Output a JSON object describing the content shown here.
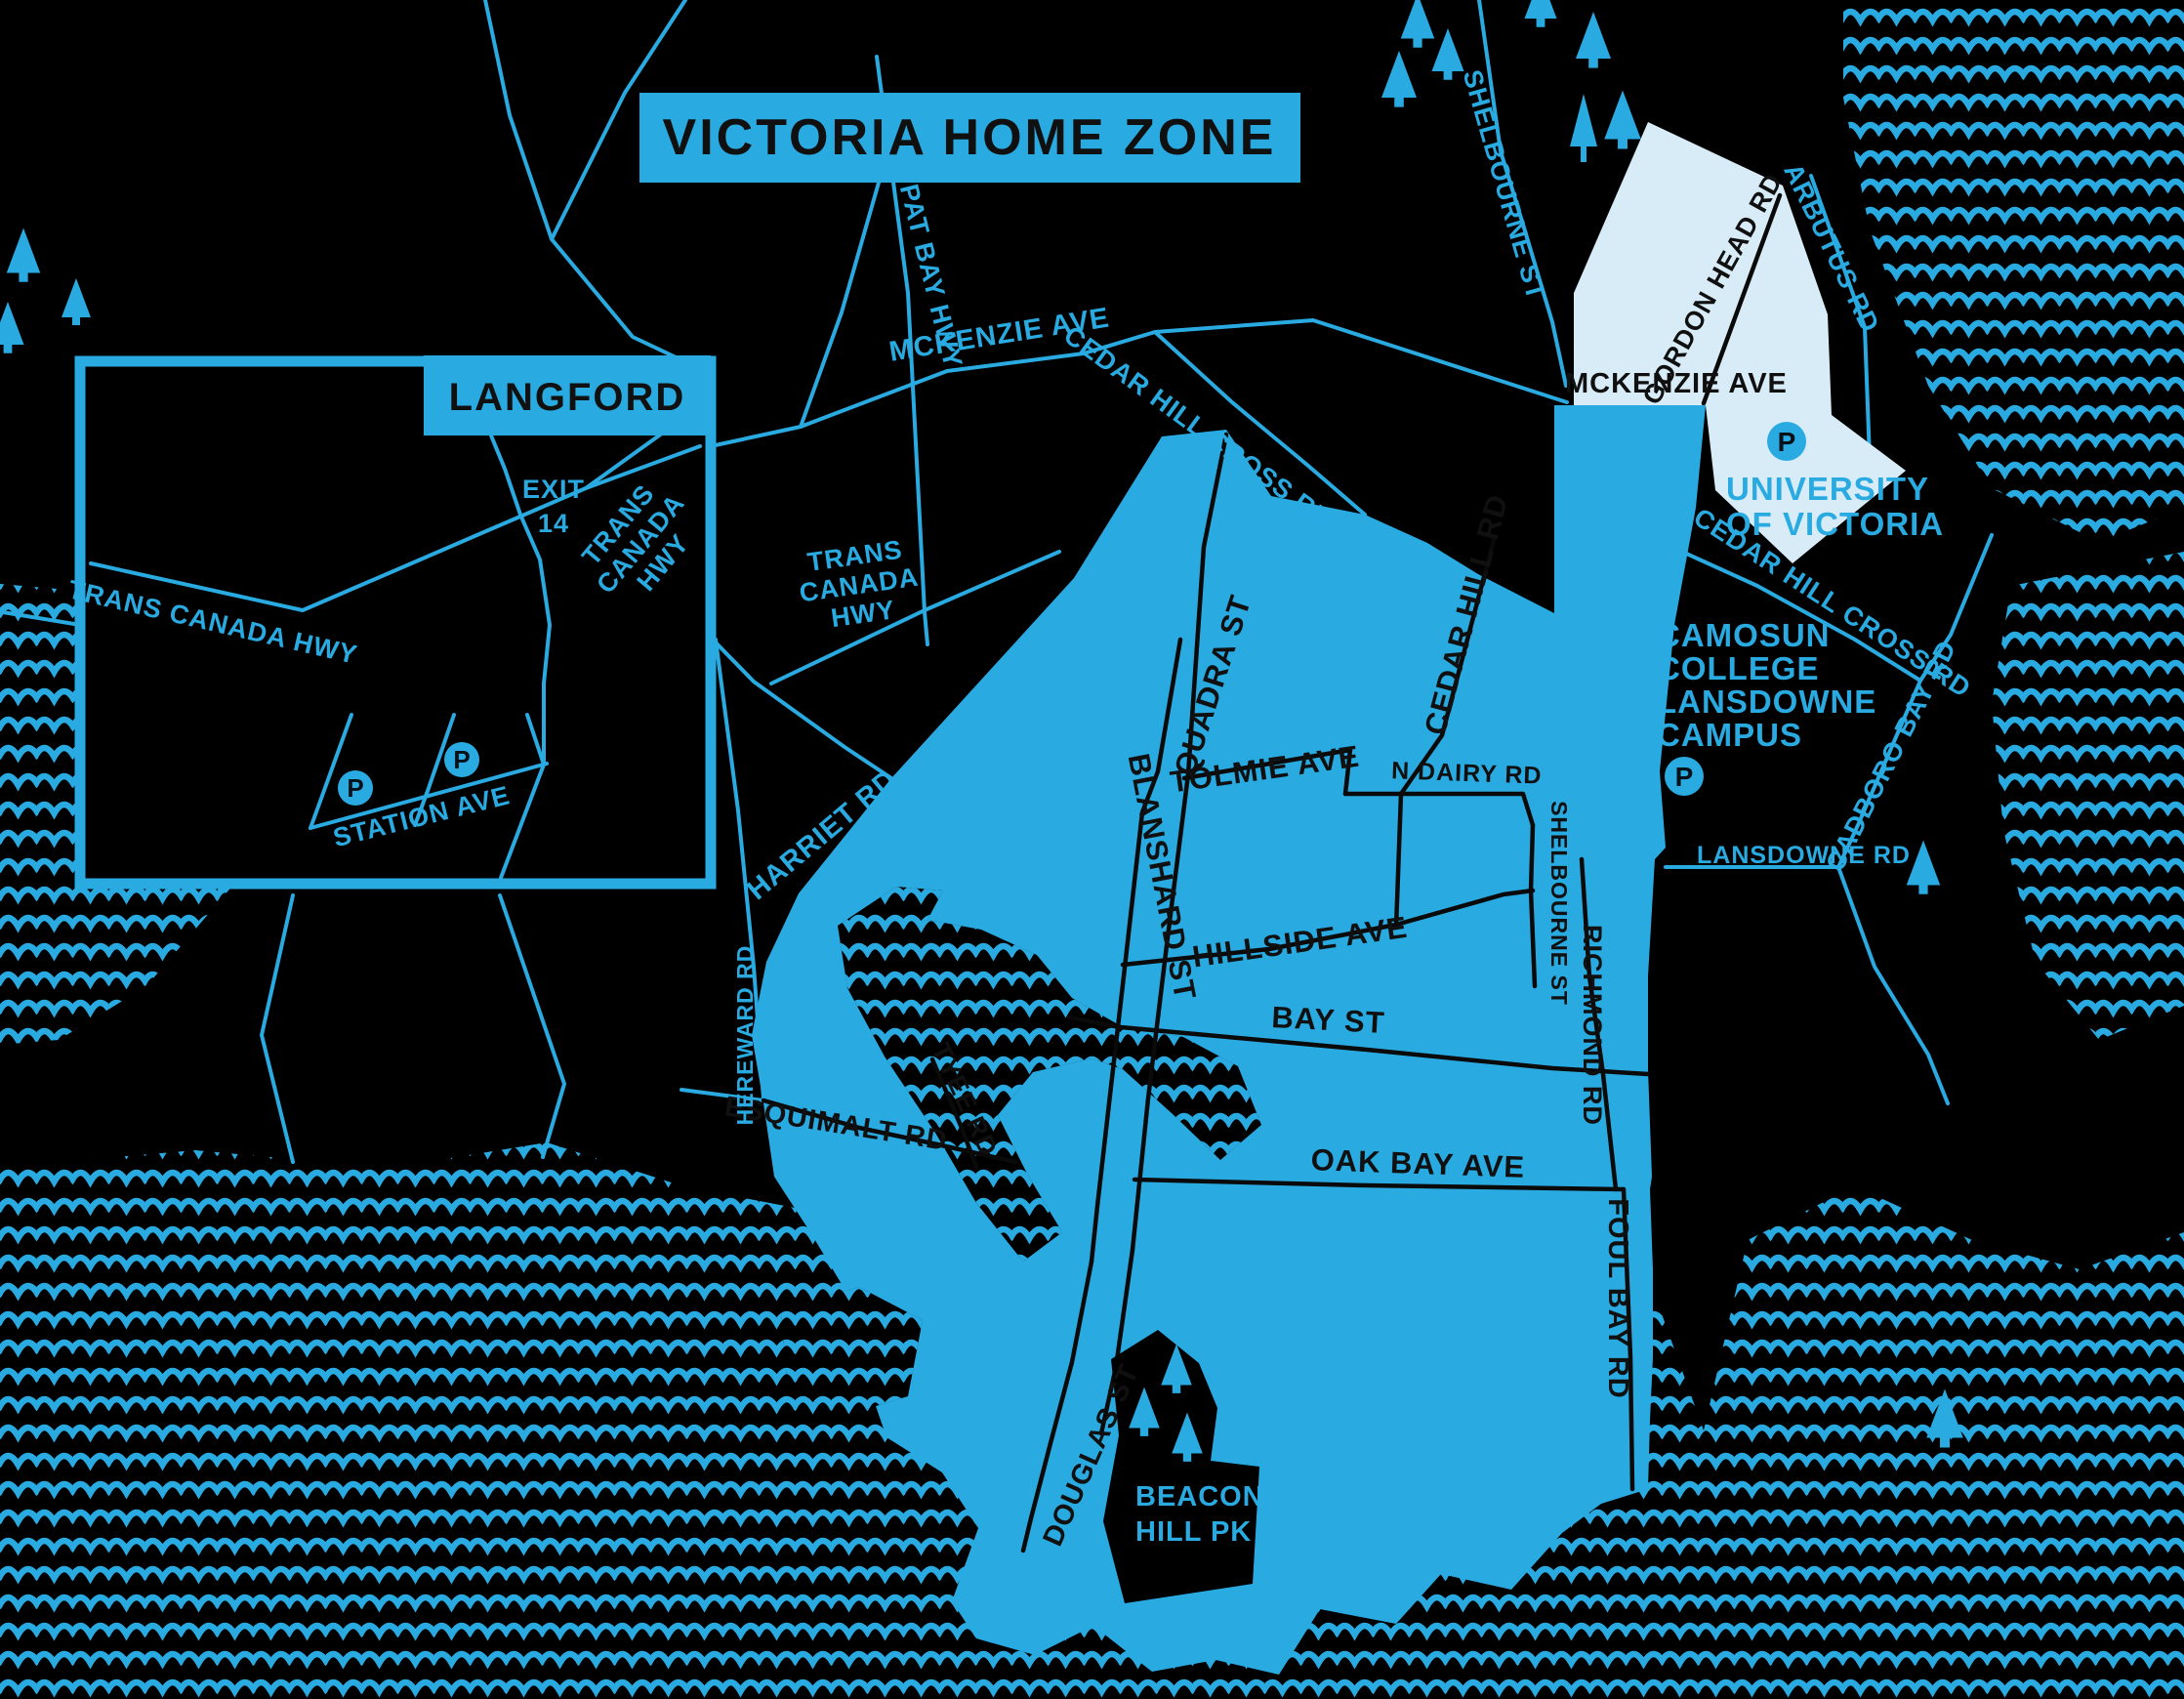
{
  "title": "VICTORIA HOME ZONE",
  "inset": {
    "name": "LANGFORD",
    "tch_west": "TRANS CANADA HWY",
    "exit_line1": "EXIT",
    "exit_line2": "14",
    "tch_east": [
      "TRANS",
      "CANADA",
      "HWY"
    ],
    "station": "STATION AVE",
    "parking": "P"
  },
  "labels_on_dark": {
    "pat_bay": "PAT BAY HWY",
    "mckenzie": "MCKENZIE AVE",
    "tch": [
      "TRANS",
      "CANADA",
      "HWY"
    ],
    "cedar_hill_cross_w": "CEDAR HILL CROSS RD",
    "shelbourne_n": "SHELBOURNE ST",
    "arbutus": "ARBUTUS RD",
    "cedar_hill_cross_e": "CEDAR HILL CROSS RD",
    "cadboro_bay": "CADBORO BAY RD",
    "lansdowne": "LANSDOWNE RD",
    "harriet": "HARRIET RD",
    "hereward": "HEREWARD RD",
    "university": [
      "UNIVERSITY",
      "OF VICTORIA"
    ],
    "camosun": [
      "CAMOSUN",
      "COLLEGE",
      "LANSDOWNE",
      "CAMPUS"
    ],
    "beacon_hill": [
      "BEACON",
      "HILL PK"
    ],
    "parking": "P"
  },
  "labels_on_zone": {
    "mckenzie_gh": "MCKENZIE AVE",
    "gordon_head": "GORDON HEAD RD",
    "quadra": "QUADRA ST",
    "tolmie": "TOLMIE AVE",
    "n_dairy": "N DAIRY RD",
    "cedar_hill": "CEDAR HILL RD",
    "blanshard": "BLANSHARD ST",
    "hillside": "HILLSIDE AVE",
    "shelbourne_s": "SHELBOURNE ST",
    "richmond": "RICHMOND RD",
    "bay": "BAY ST",
    "oak_bay": "OAK BAY AVE",
    "foul_bay": "FOUL BAY RD",
    "esquimalt": "ESQUIMALT RD",
    "tyee": "TYEE RD",
    "douglas": "DOUGLAS ST"
  },
  "colors": {
    "accent_blue": "#29ABE2",
    "pale_blue": "#D8ECF7",
    "background": "#000000",
    "label_dark": "#101010"
  }
}
